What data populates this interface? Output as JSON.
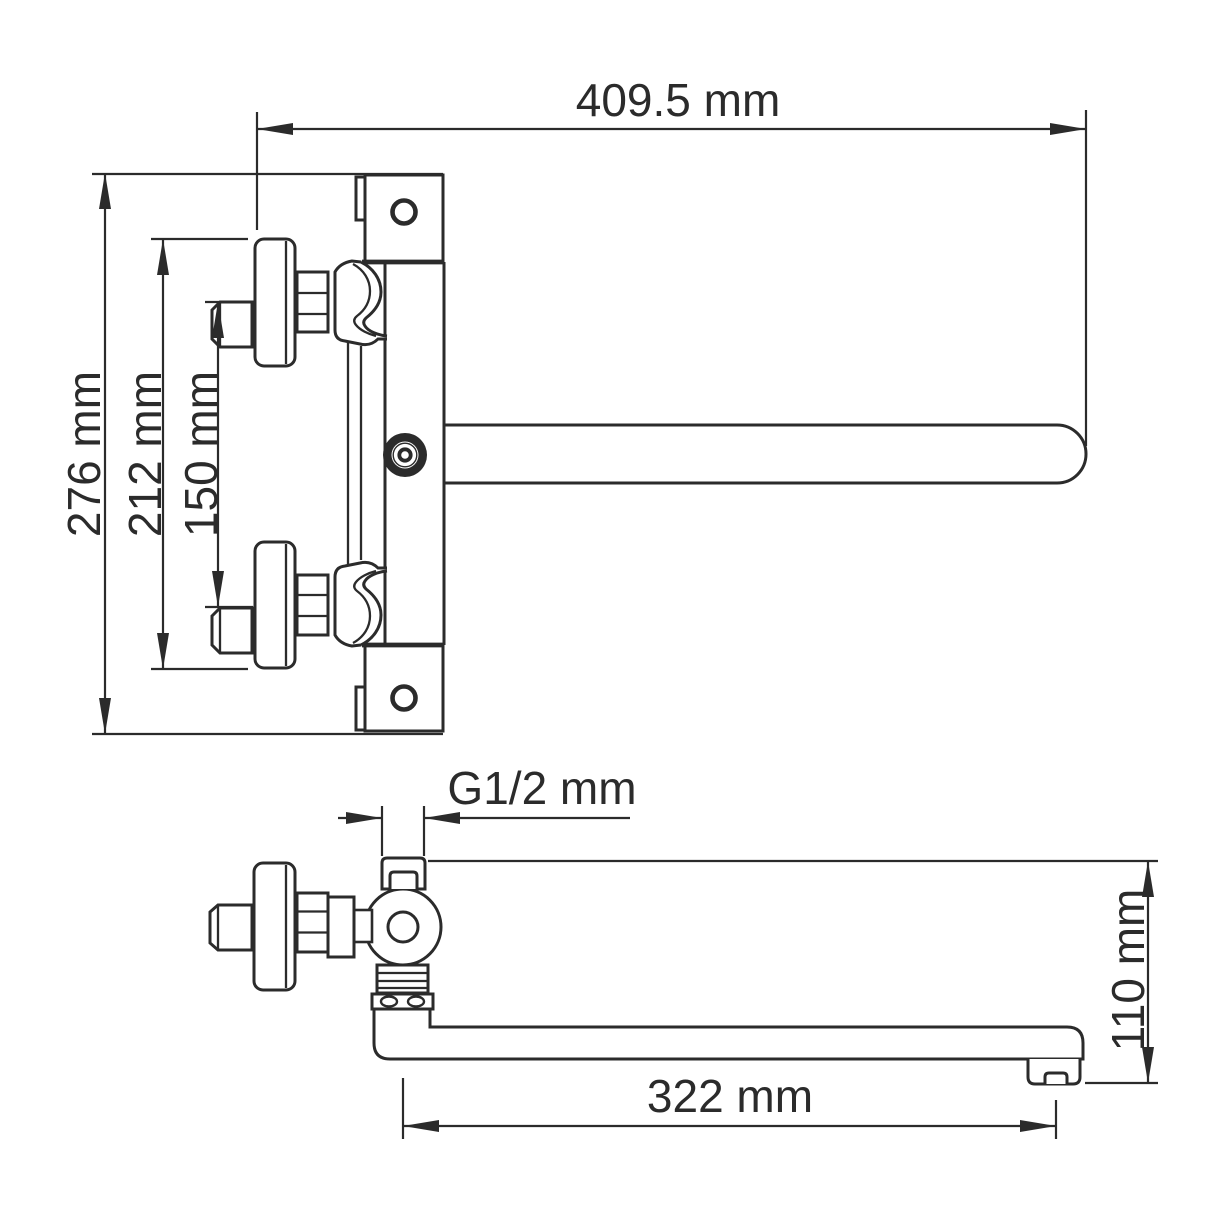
{
  "drawing": {
    "background_color": "#ffffff",
    "line_color": "#2b2b2b",
    "front_view": {
      "width_label": "409.5 mm",
      "height_label": "276 mm",
      "escutcheon_span_label": "212 mm",
      "inlet_spacing_label": "150 mm"
    },
    "side_view": {
      "thread_label": "G1/2 mm",
      "spout_length_label": "322 mm",
      "spout_height_label": "110 mm"
    }
  }
}
